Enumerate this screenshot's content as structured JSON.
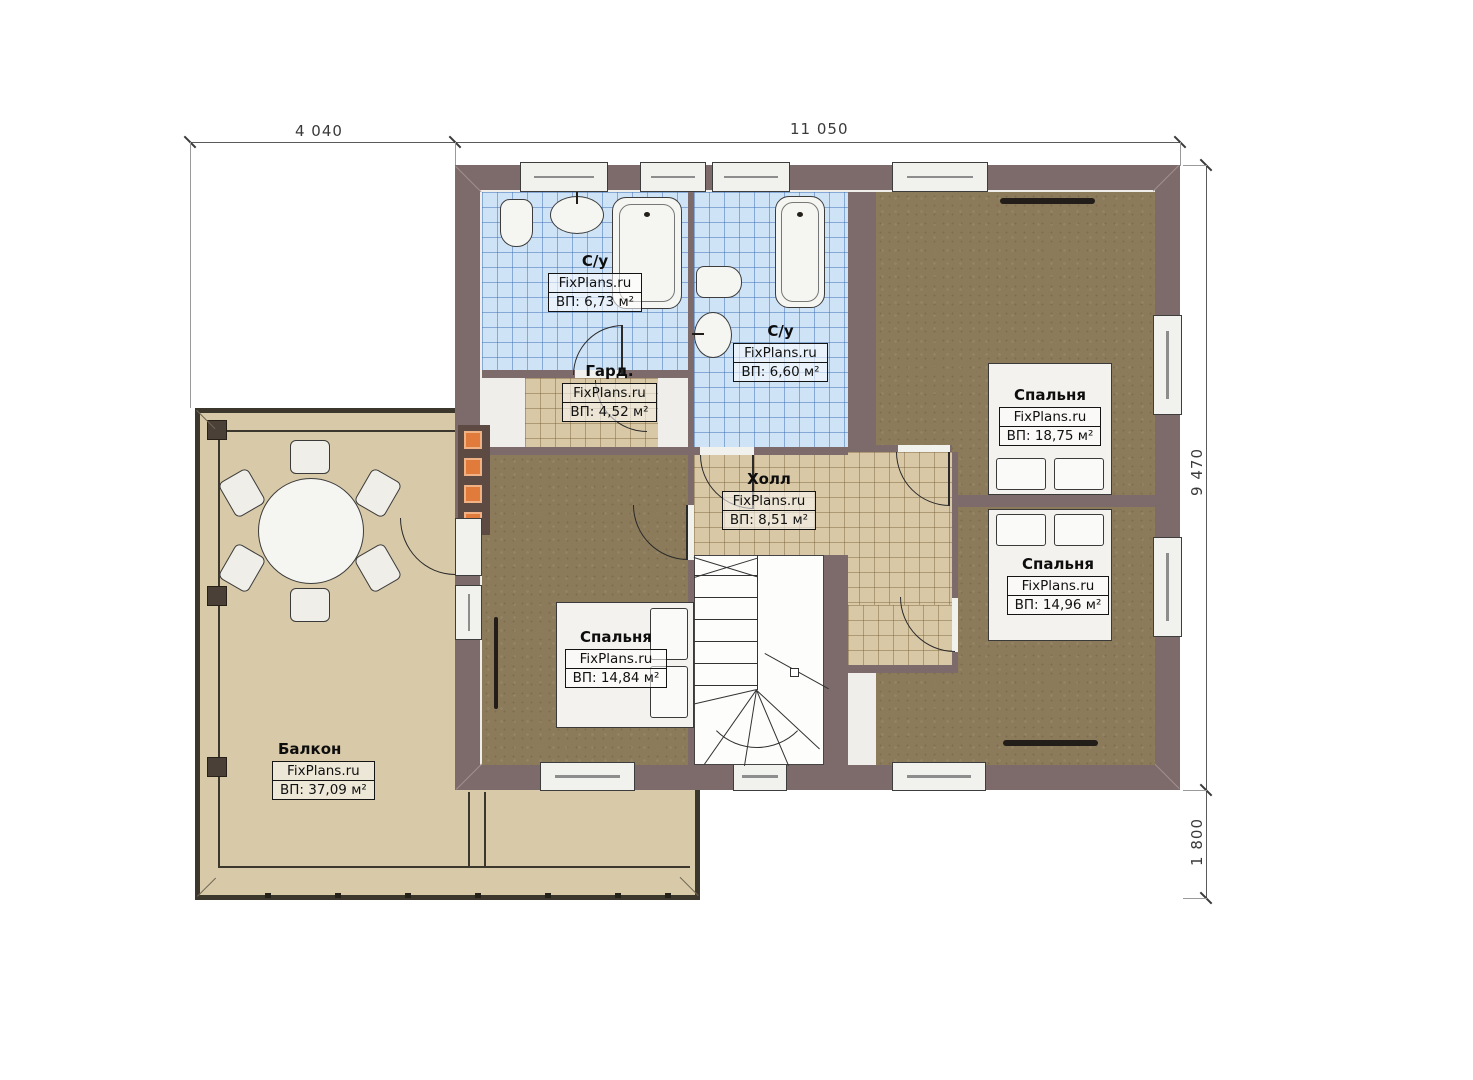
{
  "plan": {
    "brand": "FixPlans.ru",
    "dimensions": {
      "top_left": "4 040",
      "top_right": "11 050",
      "right_main": "9 470",
      "right_balcony": "1 800"
    },
    "rooms": [
      {
        "name": "С/у",
        "brand": "FixPlans.ru",
        "area": "ВП: 6,73 м²"
      },
      {
        "name": "С/у",
        "brand": "FixPlans.ru",
        "area": "ВП: 6,60 м²"
      },
      {
        "name": "Гард.",
        "brand": "FixPlans.ru",
        "area": "ВП: 4,52 м²"
      },
      {
        "name": "Холл",
        "brand": "FixPlans.ru",
        "area": "ВП: 8,51 м²"
      },
      {
        "name": "Спальня",
        "brand": "FixPlans.ru",
        "area": "ВП: 18,75 м²"
      },
      {
        "name": "Спальня",
        "brand": "FixPlans.ru",
        "area": "ВП: 14,96 м²"
      },
      {
        "name": "Спальня",
        "brand": "FixPlans.ru",
        "area": "ВП: 14,84 м²"
      },
      {
        "name": "Балкон",
        "brand": "FixPlans.ru",
        "area": "ВП: 37,09 м²"
      }
    ],
    "colors": {
      "wall": "#7d6a6a",
      "tile_blue": "#cfe3f6",
      "tile_beige": "#d8c8a6",
      "floor_brown": "#8b7b5a",
      "balcony_floor": "#d8c9a8",
      "accent_orange": "#e07b3c"
    }
  }
}
